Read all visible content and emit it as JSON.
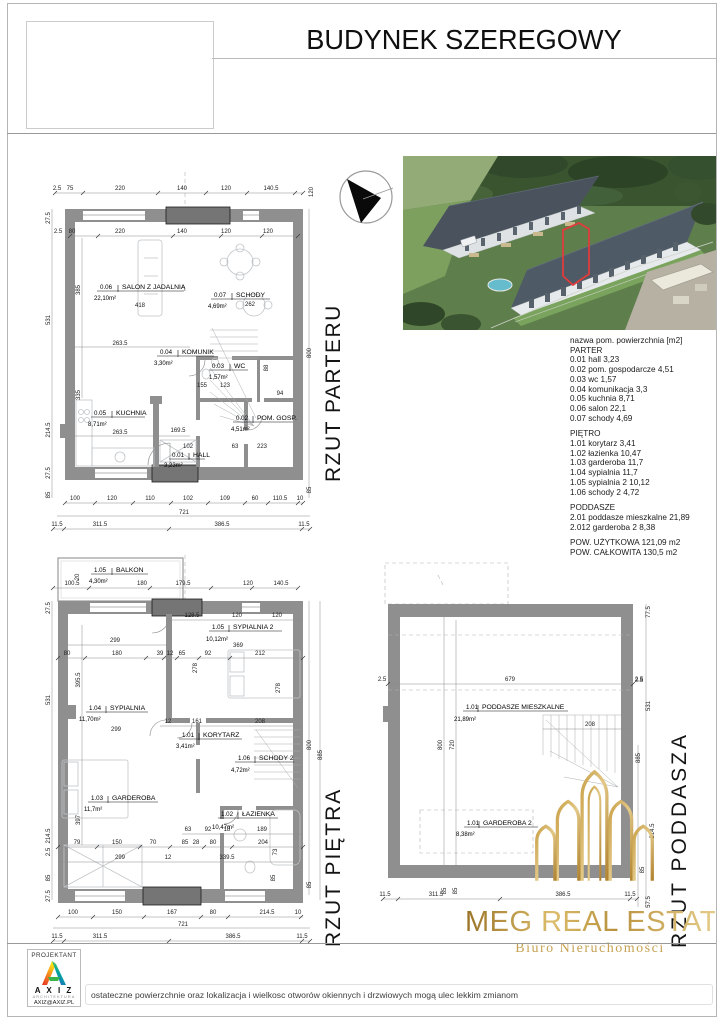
{
  "header": {
    "title": "BUDYNEK SZEREGOWY"
  },
  "legend": {
    "header": "nazwa pom. powierzchnia [m2]",
    "sections": [
      {
        "title": "PARTER",
        "items": [
          "0.01 hall 3,23",
          "0.02 pom. gospodarcze 4,51",
          "0.03 wc 1,57",
          "0.04 komunikacja 3,3",
          "0.05 kuchnia 8,71",
          "0.06 salon  22,1",
          "0.07 schody 4,69"
        ]
      },
      {
        "title": "PIĘTRO",
        "items": [
          "1.01 korytarz 3,41",
          "1.02 łazienka 10,47",
          "1.03 garderoba 11,7",
          "1.04 sypialnia 11,7",
          "1.05 sypialnia 2 10,12",
          "1.06 schody 2 4,72"
        ]
      },
      {
        "title": "PODDASZE",
        "items": [
          "2.01 poddasze mieszkalne 21,89",
          "2.012 garderoba 2 8,38"
        ]
      }
    ],
    "totals": [
      "POW. UŻYTKOWA 121,09 m2",
      "POW. CAŁKOWITA 130,5 m2"
    ]
  },
  "plans": {
    "parter": {
      "title": "RZUT PARTERU",
      "rooms": [
        {
          "code": "0.06",
          "name": "SALON Z JADALNIĄ",
          "area": "22,10m²",
          "extra": "418"
        },
        {
          "code": "0.07",
          "name": "SCHODY",
          "area": "4,69m²",
          "extra": "262"
        },
        {
          "code": "0.04",
          "name": "KOMUNIK",
          "area": "3,30m²"
        },
        {
          "code": "0.03",
          "name": "WC",
          "area": "1,57m²"
        },
        {
          "code": "0.05",
          "name": "KUCHNIA",
          "area": "8,71m²"
        },
        {
          "code": "0.02",
          "name": "POM. GOSP.",
          "area": "4,51m²"
        },
        {
          "code": "0.01",
          "name": "HALL",
          "area": "3,23m²"
        }
      ],
      "dims": {
        "top1": [
          "2.5",
          "75",
          "220",
          "140",
          "120",
          "140.5"
        ],
        "topRight": "120",
        "top2": [
          "2.5",
          "80",
          "220",
          "140",
          "120",
          "120"
        ],
        "left": [
          "27.5",
          "531",
          "214.5",
          "27.5",
          "85"
        ],
        "leftInner": [
          "385",
          "335"
        ],
        "inner": [
          "263.5",
          "155",
          "123",
          "88",
          "94",
          "263.5",
          "169.5",
          "102",
          "63",
          "223"
        ],
        "right": [
          "800",
          "885",
          "85"
        ],
        "bottom1": [
          "100",
          "120",
          "110",
          "102",
          "109",
          "60",
          "110.5",
          "10"
        ],
        "total": "721",
        "bottom2": [
          "11.5",
          "311.5",
          "386.5",
          "11.5"
        ]
      }
    },
    "pietro": {
      "title": "RZUT PIĘTRA",
      "rooms": [
        {
          "code": "1.05",
          "name": "BALKON",
          "area": "4,30m²"
        },
        {
          "code": "1.05",
          "name": "SYPIALNIA 2",
          "area": "10,12m²",
          "extra": "369"
        },
        {
          "code": "1.04",
          "name": "SYPIALNIA",
          "area": "11,70m²",
          "extra": "299"
        },
        {
          "code": "1.01",
          "name": "KORYTARZ",
          "area": "3,41m²"
        },
        {
          "code": "1.06",
          "name": "SCHODY 2",
          "area": "4,72m²"
        },
        {
          "code": "1.03",
          "name": "GARDEROBA",
          "area": "11,7m²"
        },
        {
          "code": "1.02",
          "name": "ŁAZIENKA",
          "area": "10,47m²"
        }
      ],
      "dims": {
        "top1": [
          "100.5",
          "180",
          "179.5",
          "120",
          "140.5"
        ],
        "v20": "20",
        "top2": [
          "128.5",
          "120",
          "120"
        ],
        "w299": "299",
        "mid1": [
          "80",
          "180",
          "39",
          "12",
          "65",
          "92",
          "212"
        ],
        "kory": [
          "12",
          "161",
          "208"
        ],
        "mid3": [
          "63",
          "92",
          "18",
          "189"
        ],
        "mid4": [
          "79",
          "150",
          "70",
          "85",
          "28",
          "80",
          "204"
        ],
        "mid5": [
          "299",
          "12",
          "339.5"
        ],
        "left": [
          "27.5",
          "531",
          "214.5",
          "2.5",
          "85",
          "27.5"
        ],
        "leftInner": [
          "395.5",
          "397"
        ],
        "innerV": [
          "278",
          "278",
          "73",
          "85"
        ],
        "right": [
          "800",
          "885",
          "85"
        ],
        "bottom1": [
          "100",
          "150",
          "167",
          "80",
          "214.5",
          "10"
        ],
        "total": "721",
        "bottom2": [
          "11.5",
          "311.5",
          "386.5",
          "11.5"
        ]
      }
    },
    "poddasze": {
      "title": "RZUT PODDASZA",
      "rooms": [
        {
          "code": "1.01",
          "name": "PODDASZE MIESZKALNE",
          "area": "21,89m²"
        },
        {
          "code": "1.01",
          "name": "GARDEROBA 2",
          "area": "8,38m²"
        }
      ],
      "dims": {
        "top": [
          "2.5",
          "679",
          "2.5"
        ],
        "innerV": [
          "800",
          "720"
        ],
        "w208": "208",
        "right": [
          "77.5",
          "2.5",
          "531",
          "885",
          "214.5",
          "85",
          "57.5"
        ],
        "bottom": [
          "11.5",
          "311.5",
          "85",
          "85",
          "386.5",
          "11.5"
        ]
      }
    }
  },
  "branding": {
    "meg": {
      "name": "MEG REAL ESTATE",
      "subtitle": "Biuro Nieruchomości"
    },
    "axiz": {
      "role": "PROJEKTANT",
      "name": "A X I Z",
      "field": "ARCHITEKTURA",
      "email": "AXIZ@AXIZ.PL"
    }
  },
  "footer": {
    "disclaimer": "ostateczne powierzchnie oraz lokalizacja i wielkosc otworów okiennych i drzwiowych mogą ulec lekkim zmianom"
  }
}
